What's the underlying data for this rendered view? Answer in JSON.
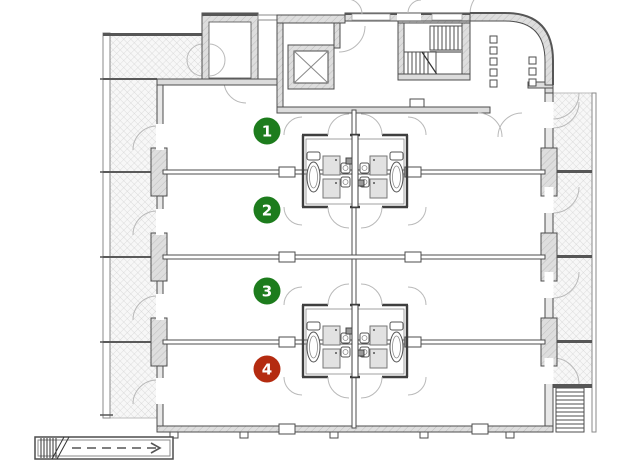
{
  "floor_plan": {
    "units": [
      {
        "label": "1",
        "badge_color": "#1d7c1d",
        "text_color": "#ffffff"
      },
      {
        "label": "2",
        "badge_color": "#1d7c1d",
        "text_color": "#ffffff"
      },
      {
        "label": "3",
        "badge_color": "#1d7c1d",
        "text_color": "#ffffff"
      },
      {
        "label": "4",
        "badge_color": "#b42b10",
        "text_color": "#ffffff"
      }
    ],
    "colors": {
      "background": "#ffffff",
      "wall_line": "#4d4d4d",
      "wall_fill": "#dcdcdc",
      "balcony_hatch_line": "#d2d2d2",
      "balcony_background": "#f7f7f7",
      "dark_edge": "#565656"
    }
  }
}
